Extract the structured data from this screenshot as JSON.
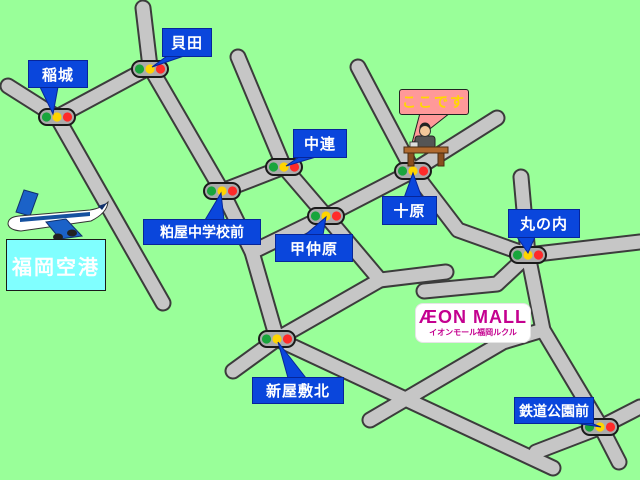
{
  "signals": [
    {
      "name": "稲城"
    },
    {
      "name": "貝田"
    },
    {
      "name": "粕屋中学校前"
    },
    {
      "name": "中連"
    },
    {
      "name": "甲仲原"
    },
    {
      "name": "十原"
    },
    {
      "name": "丸の内"
    },
    {
      "name": "新屋敷北"
    },
    {
      "name": "鉄道公園前"
    }
  ],
  "destination_callout": {
    "text": "ここです"
  },
  "airport": {
    "name": "福岡空港"
  },
  "aeon_mall": {
    "logo_text": "ÆON MALL",
    "subtitle": "イオンモール福岡ルクル"
  },
  "icons": {
    "airplane": "airplane-icon",
    "reception_desk": "reception-desk-icon",
    "traffic_signal": "traffic-signal-icon"
  },
  "colors": {
    "bg": "#99FF99",
    "road": "#C6C6C6",
    "road-edge": "#3C3C3C",
    "label-bg": "#0A46DC",
    "label-border": "#06259A",
    "here-bg": "#FF9999",
    "here-text": "#FFD700",
    "airport-bg": "#80FFFF",
    "aeon": "#C4008F",
    "sig-green": "#18A53C",
    "sig-yellow": "#FFD400",
    "sig-red": "#FF2A2A"
  }
}
